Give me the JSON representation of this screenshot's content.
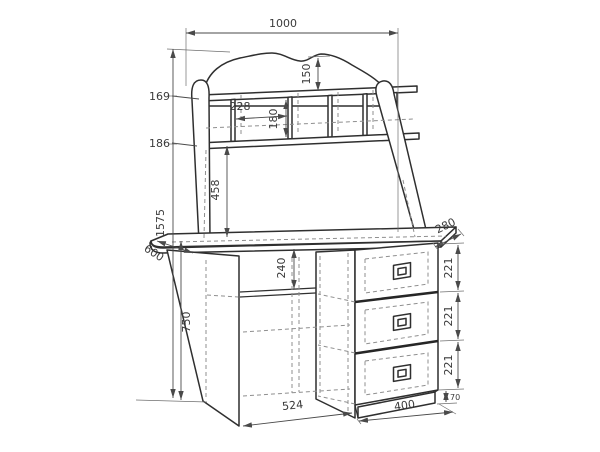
{
  "drawing": {
    "type": "furniture-technical-drawing",
    "subject": "writing desk with hutch shelving and three-drawer pedestal",
    "units": "mm",
    "background": "#ffffff",
    "line_color": "#2f2f2f",
    "dimension_color": "#4a4a4a",
    "hidden_line_color": "#8f8f8f",
    "dims": {
      "overall_width": "1000",
      "crest_height": "150",
      "top_shelf_offset": "169",
      "cubby_width": "228",
      "cubby_height": "180",
      "shelf_spacing": "186",
      "hutch_opening_height": "458",
      "total_height": "1575",
      "desk_depth": "600",
      "under_top_drop": "240",
      "hutch_depth": "280",
      "drawer_height_1": "221",
      "drawer_height_2": "221",
      "drawer_height_3": "221",
      "plinth_height": "70",
      "desk_height": "750",
      "kneehole_width": "524",
      "drawer_unit_width": "400"
    }
  }
}
